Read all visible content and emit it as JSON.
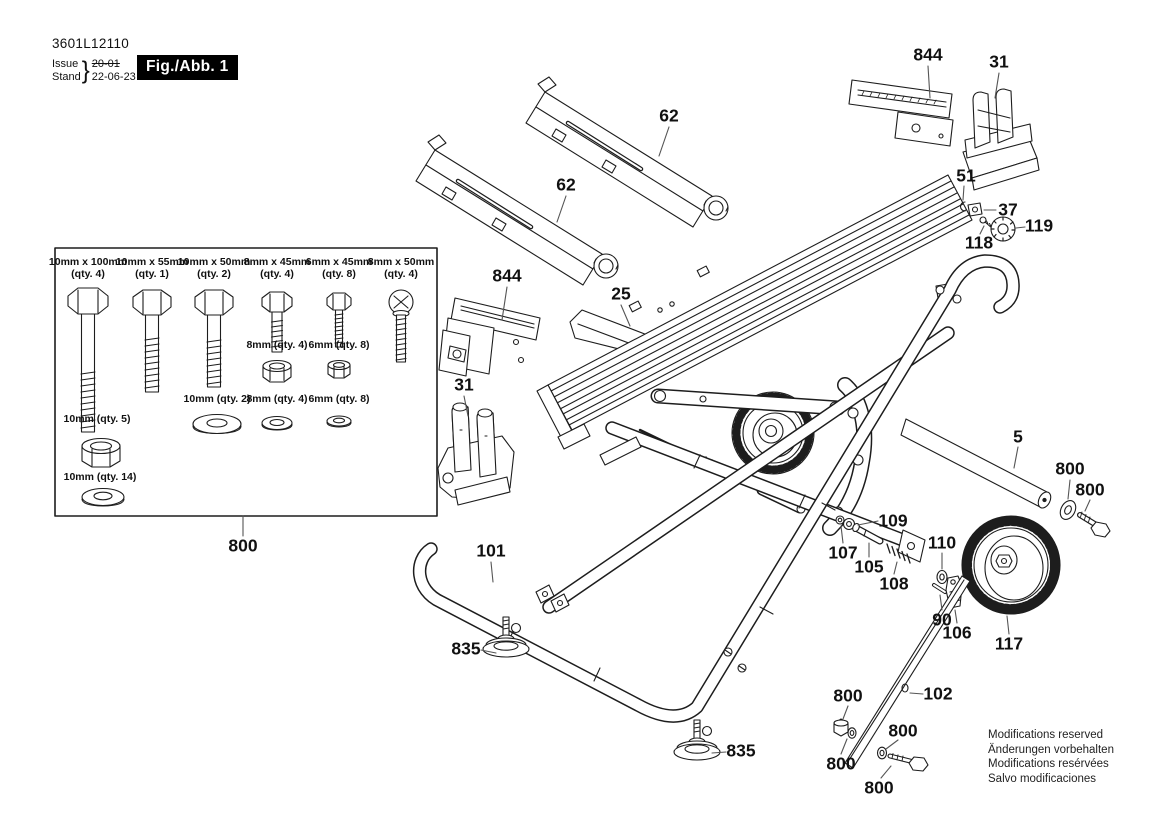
{
  "header": {
    "part_number": "3601L12110",
    "issue_label": "Issue",
    "issue_value": "20-01",
    "stand_label": "Stand",
    "stand_value": "22-06-23",
    "brace": "}",
    "figure_label": "Fig./Abb. 1"
  },
  "footer_notice": {
    "lines": [
      "Modifications reserved",
      "Änderungen vorbehalten",
      "Modifications resérvées",
      "Salvo modificaciones"
    ]
  },
  "hardware_box": {
    "callout": "800",
    "items": [
      {
        "type": "hex-bolt",
        "line1": "10mm x 100mm",
        "line2": "(qty. 4)",
        "x": 88,
        "y": 256
      },
      {
        "type": "hex-bolt",
        "line1": "10mm x 55mm",
        "line2": "(qty. 1)",
        "x": 152,
        "y": 256
      },
      {
        "type": "hex-bolt",
        "line1": "10mm x 50mm",
        "line2": "(qty. 2)",
        "x": 214,
        "y": 256
      },
      {
        "type": "hex-bolt",
        "line1": "8mm x 45mm",
        "line2": "(qty. 4)",
        "x": 277,
        "y": 256
      },
      {
        "type": "hex-bolt",
        "line1": "6mm x 45mm",
        "line2": "(qty. 8)",
        "x": 339,
        "y": 256
      },
      {
        "type": "cross-bolt",
        "line1": "8mm x 50mm",
        "line2": "(qty. 4)",
        "x": 401,
        "y": 256
      },
      {
        "type": "lock-nut",
        "line1": "8mm (qty. 4)",
        "line2": "",
        "x": 277,
        "y": 339
      },
      {
        "type": "lock-nut",
        "line1": "6mm (qty. 8)",
        "line2": "",
        "x": 339,
        "y": 339
      },
      {
        "type": "washer",
        "line1": "10mm (qty. 2)",
        "line2": "",
        "x": 217,
        "y": 393
      },
      {
        "type": "washer",
        "line1": "8mm (qty. 4)",
        "line2": "",
        "x": 277,
        "y": 393
      },
      {
        "type": "washer",
        "line1": "6mm (qty. 8)",
        "line2": "",
        "x": 339,
        "y": 393
      },
      {
        "type": "lock-nut",
        "line1": "10mm (qty. 5)",
        "line2": "",
        "x": 97,
        "y": 413
      },
      {
        "type": "washer",
        "line1": "10mm (qty. 14)",
        "line2": "",
        "x": 100,
        "y": 471
      }
    ]
  },
  "callouts": [
    {
      "text": "844",
      "x": 928,
      "y": 55
    },
    {
      "text": "31",
      "x": 999,
      "y": 62
    },
    {
      "text": "62",
      "x": 669,
      "y": 116
    },
    {
      "text": "62",
      "x": 566,
      "y": 185
    },
    {
      "text": "51",
      "x": 966,
      "y": 176
    },
    {
      "text": "37",
      "x": 1008,
      "y": 210
    },
    {
      "text": "119",
      "x": 1039,
      "y": 226
    },
    {
      "text": "118",
      "x": 979,
      "y": 243
    },
    {
      "text": "844",
      "x": 507,
      "y": 276
    },
    {
      "text": "25",
      "x": 621,
      "y": 294
    },
    {
      "text": "31",
      "x": 464,
      "y": 385
    },
    {
      "text": "5",
      "x": 1018,
      "y": 437
    },
    {
      "text": "800",
      "x": 1070,
      "y": 469
    },
    {
      "text": "800",
      "x": 1090,
      "y": 490
    },
    {
      "text": "109",
      "x": 893,
      "y": 521
    },
    {
      "text": "107",
      "x": 843,
      "y": 553
    },
    {
      "text": "110",
      "x": 942,
      "y": 543
    },
    {
      "text": "105",
      "x": 869,
      "y": 567
    },
    {
      "text": "108",
      "x": 894,
      "y": 584
    },
    {
      "text": "90",
      "x": 942,
      "y": 620
    },
    {
      "text": "106",
      "x": 957,
      "y": 633
    },
    {
      "text": "117",
      "x": 1009,
      "y": 644
    },
    {
      "text": "101",
      "x": 491,
      "y": 551
    },
    {
      "text": "835",
      "x": 466,
      "y": 649
    },
    {
      "text": "835",
      "x": 741,
      "y": 751
    },
    {
      "text": "800",
      "x": 848,
      "y": 696
    },
    {
      "text": "102",
      "x": 938,
      "y": 694
    },
    {
      "text": "800",
      "x": 903,
      "y": 731
    },
    {
      "text": "800",
      "x": 841,
      "y": 764
    },
    {
      "text": "800",
      "x": 879,
      "y": 788
    },
    {
      "text": "800",
      "x": 243,
      "y": 546
    }
  ]
}
